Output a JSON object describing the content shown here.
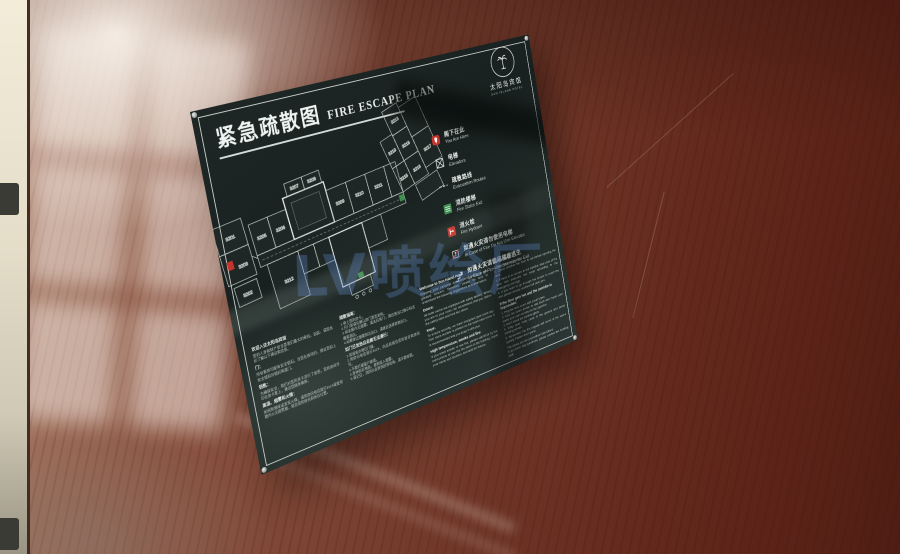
{
  "sign": {
    "title_zh": "紧急疏散图",
    "title_en": "FIRE ESCAPE PLAN",
    "logo": {
      "icon": "palm-tree-icon",
      "hotel_zh": "太阳岛宾馆",
      "hotel_en": "SUN ISLAND HOTEL"
    },
    "legend": {
      "items": [
        {
          "icon": "you-are-here-icon",
          "zh": "阁下在此",
          "en": "You Are Here"
        },
        {
          "icon": "elevator-icon",
          "zh": "电梯",
          "en": "Elevators"
        },
        {
          "icon": "route-dash-icon",
          "zh": "疏散路线",
          "en": "Evacuation Routes"
        },
        {
          "icon": "fire-stairs-icon",
          "zh": "消防楼梯",
          "en": "Fire Stairs Exit"
        },
        {
          "icon": "fire-hydrant-icon",
          "zh": "消火栓",
          "en": "Fire Hydrant"
        },
        {
          "icon": "no-elevator-icon",
          "zh": "如遇火灾请勿使用电梯",
          "en": "In Case of Fire Do Not Use Elevator"
        },
        {
          "icon": "stairway-exit-icon",
          "zh": "如遇火灾请使用楼梯逃生",
          "en": "In Case of Fire Use Stairway for Exit"
        }
      ]
    },
    "floorplan": {
      "rooms": [
        "3201",
        "3202",
        "3203",
        "3205",
        "3206",
        "3207",
        "3208",
        "3209",
        "3210",
        "3211",
        "3212",
        "3213",
        "3215",
        "3216",
        "3217",
        "3218",
        "3219"
      ]
    },
    "notices": {
      "col1": {
        "title": "欢迎入住太阳岛宾馆",
        "intro": "您的人身和财产安全是我们最大的牵挂。因此，请您务必了解以下建议和信息。",
        "s1h": "门：",
        "s1b": "所有客房均配有安全锁扣。当您在房间时，建议您扣上安全锁扣并锁好两道门。",
        "s2h": "钥匙：",
        "s2b": "为确保安全，我们对您的房卡进行了加密。您的房间号印在房卡套上，建议您随身携带。",
        "s3h": "高温、烟雾和火情：",
        "s3b": "如闻到烟味或发现火情，请用房间电话拨打8119或使用楼内火灾报警器，报告您的姓名和所在位置。"
      },
      "col2": {
        "h1": "疏散指南：",
        "list1": "1.带上您的房卡。\n2.开门前请先确认房门是否发热。\n3.如走廊内无烟雾，请关好房门，按应急出口指示标志撤离酒店。\n4.如需穿过烟雾到达出口，请就近选择其他出口。",
        "h2": "如门已发热且走廊无法通行：",
        "list2": "1.用湿毛巾堵住门缝。\n2.用房间电话拨打8119，向总机报告您的姓名和房间号。\n3.不要打破窗户玻璃。\n4.身体贴近地面，避免吸入烟雾。\n5.请记住，消防队会很快赶到现场，请不要惊慌。"
      },
      "col3": {
        "title": "Welcome to Sun Island Hotel",
        "intro": "Enjoying your personal and property safety is our greatest concern. Therefore, please be sure to understand the following suggestions and information.",
        "s1h": "Doors:",
        "s1b": "All hotel rooms are equipped with safety latches. When you are in your room, we recommend that you fasten the safety latch and lock two doors.",
        "s2h": "Keys:",
        "s2b": "To ensure security, we have encrypted your room key. Your room number is printed on the room card cover. It is recommended that you keep it with you.",
        "s3h": "High temperature, smoke and fire:",
        "s3b": "If you smell smoke or see fire, please call 8119 by the room phone or use the fire alarm in the building, report your name and location, and wait for rescue."
      },
      "col4": {
        "h1": "Instructions:",
        "list1": "1. Bring your room card.\n2. Check whether the door is hot before opening the door.\n3. If there is no smoke in the corridor, take care of the door and evacuate the hotel according to the emergency exit sign.\n4. If you need to go through the smoke to reach the exit, please choose another exit near you.",
        "h2": "If the door gets hot and the corridor is impossible:",
        "list2": "1. Plug the door seam with a wet towel.\n2. Use the room phone to dial 8119 and report your name and room number to the operator.\n3. Don't break the window glass.\n4. Keep your body close to the ground and avoid inhaling smoke.\n5. Remember the fire brigade will arrive at the scene quickly. Please don't panic.",
        "tail": "The above are fire prevention instructions.\nIf you have any questions, please contact the building staff."
      }
    }
  },
  "watermark": {
    "text": "LV喷绘厂"
  },
  "colors": {
    "sign_background": "#1e2725",
    "sign_text": "#dde6e2",
    "accent_red": "#c6342c",
    "accent_green": "#3f8f52",
    "watermark_blue": "#648ed8",
    "wood_brown": "#6e3527",
    "wall_beige": "#ece5d2"
  }
}
